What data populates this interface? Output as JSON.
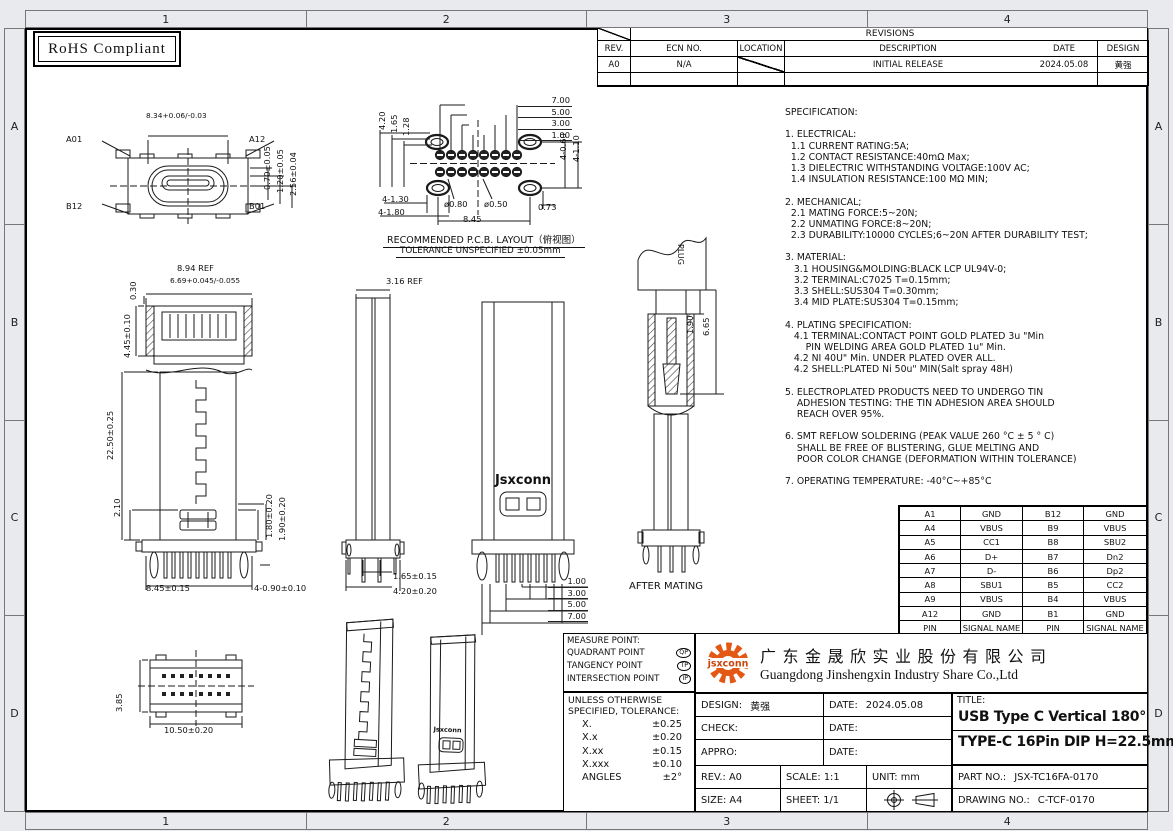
{
  "sheet": {
    "rohs": "RoHS Compliant",
    "zone_cols": [
      "1",
      "2",
      "3",
      "4"
    ],
    "zone_rows": [
      "A",
      "B",
      "C",
      "D"
    ]
  },
  "revisions": {
    "title": "REVISIONS",
    "headers": [
      "REV.",
      "ECN NO.",
      "LOCATION",
      "DESCRIPTION",
      "DATE",
      "DESIGN"
    ],
    "row": {
      "rev": "A0",
      "ecn": "N/A",
      "desc": "INITIAL RELEASE",
      "date": "2024.05.08",
      "design": "黄强"
    }
  },
  "specification": {
    "lines": [
      "SPECIFICATION:",
      "",
      "1. ELECTRICAL:",
      "  1.1 CURRENT RATING:5A;",
      "  1.2 CONTACT RESISTANCE:40mΩ Max;",
      "  1.3 DIELECTRIC WITHSTANDING VOLTAGE:100V AC;",
      "  1.4 INSULATION RESISTANCE:100 MΩ MIN;",
      "",
      "2. MECHANICAL;",
      "  2.1 MATING FORCE:5~20N;",
      "  2.2 UNMATING FORCE:8~20N;",
      "  2.3 DURABILITY:10000 CYCLES;6~20N AFTER DURABILITY TEST;",
      "",
      "3. MATERIAL:",
      "   3.1 HOUSING&MOLDING:BLACK LCP UL94V-0;",
      "   3.2 TERMINAL:C7025 T=0.15mm;",
      "   3.3 SHELL:SUS304 T=0.30mm;",
      "   3.4 MID PLATE:SUS304 T=0.15mm;",
      "",
      "4. PLATING SPECIFICATION:",
      "   4.1 TERMINAL:CONTACT POINT GOLD PLATED 3u \"Min",
      "       PIN WELDING AREA GOLD PLATED 1u\" Min.",
      "   4.2 NI 40U\" Min. UNDER PLATED OVER ALL.",
      "   4.2 SHELL:PLATED Ni 50u\" MIN(Salt spray 48H)",
      "",
      "5. ELECTROPLATED PRODUCTS NEED TO UNDERGO TIN",
      "    ADHESION TESTING: THE TIN ADHESION AREA SHOULD",
      "    REACH OVER 95%.",
      "",
      "6. SMT REFLOW SOLDERING (PEAK VALUE 260 °C ± 5 ° C)",
      "    SHALL BE FREE OF BLISTERING, GLUE MELTING AND",
      "    POOR COLOR CHANGE (DEFORMATION WITHIN TOLERANCE)",
      "",
      "7. OPERATING TEMPERATURE: -40°C~+85°C"
    ]
  },
  "pin_table": {
    "rows": [
      [
        "A1",
        "GND",
        "B12",
        "GND"
      ],
      [
        "A4",
        "VBUS",
        "B9",
        "VBUS"
      ],
      [
        "A5",
        "CC1",
        "B8",
        "SBU2"
      ],
      [
        "A6",
        "D+",
        "B7",
        "Dn2"
      ],
      [
        "A7",
        "D-",
        "B6",
        "Dp2"
      ],
      [
        "A8",
        "SBU1",
        "B5",
        "CC2"
      ],
      [
        "A9",
        "VBUS",
        "B4",
        "VBUS"
      ],
      [
        "A12",
        "GND",
        "B1",
        "GND"
      ],
      [
        "PIN",
        "SIGNAL NAME",
        "PIN",
        "SIGNAL NAME"
      ]
    ]
  },
  "views": {
    "top": {
      "pins": [
        "A01",
        "A12",
        "B12",
        "B01"
      ],
      "w": "8.34+0.06/-0.03",
      "right": [
        "0.70±0.05",
        "1.20±0.05",
        "2.56±0.04"
      ]
    },
    "pcb": {
      "left": [
        "4.20",
        "1.65",
        "1.28"
      ],
      "top": [
        "7.00",
        "5.00",
        "3.00",
        "1.00"
      ],
      "right": [
        "4-0.60",
        "4-1.10"
      ],
      "holes": [
        "4-1.30",
        "4-1.80"
      ],
      "dia": [
        "ø0.80",
        "ø0.50"
      ],
      "span": "8.45",
      "off": "0.73",
      "caption": "RECOMMENDED   P.C.B.  LAYOUT（俯视图）",
      "note": "TOLERANCE  UNSPECIFIED  ±0.05mm"
    },
    "front": {
      "w_ref": "8.94  REF",
      "tongue": "6.69+0.045/-0.055",
      "d030": "0.30",
      "d445": "4.45±0.10",
      "d2250": "22.50±0.25",
      "d210": "2.10",
      "d180": "1.80±0.20",
      "d190": "1.90±0.20",
      "span": "8.45±0.15",
      "holes": "4-0.90±0.10"
    },
    "side": {
      "w_ref": "3.16  REF",
      "d165": "1.65±0.15",
      "d420": "4.20±0.20"
    },
    "back": {
      "brand": "Jsxconn",
      "dims": [
        "1.00",
        "3.00",
        "5.00",
        "7.00"
      ]
    },
    "mating": {
      "plug": "PLUG",
      "d190": "1.90",
      "d665": "6.65",
      "caption": "AFTER  MATING"
    },
    "bottom": {
      "h": "3.85",
      "w": "10.50±0.20"
    }
  },
  "title_block": {
    "measure": {
      "title": "MEASURE POINT:",
      "rows": [
        {
          "label": "QUADRANT POINT",
          "sym": "QP"
        },
        {
          "label": "TANGENCY POINT",
          "sym": "TP"
        },
        {
          "label": "INTERSECTION POINT",
          "sym": "IP"
        }
      ]
    },
    "tol": {
      "l1": "UNLESS OTHERWISE",
      "l2": "SPECIFIED, TOLERANCE:",
      "rows": [
        {
          "k": "X.",
          "v": "±0.25"
        },
        {
          "k": "X.x",
          "v": "±0.20"
        },
        {
          "k": "X.xx",
          "v": "±0.15"
        },
        {
          "k": "X.xxx",
          "v": "±0.10"
        },
        {
          "k": "ANGLES",
          "v": "±2°"
        }
      ]
    },
    "company": {
      "logo": "jsxconn",
      "cn": "广东金晟欣实业股份有限公司",
      "en": "Guangdong Jinshengxin Industry Share Co.,Ltd"
    },
    "design_l": "DESIGN:",
    "design_v": "黄强",
    "check_l": "CHECK:",
    "appro_l": "APPRO:",
    "date_l": "DATE:",
    "design_date": "2024.05.08",
    "rev": "REV.: A0",
    "scale": "SCALE: 1:1",
    "unit": "UNIT: mm",
    "size": "SIZE: A4",
    "sheet": "SHEET: 1/1",
    "title_l": "TITLE:",
    "title1": "USB Type C Vertical 180°",
    "title2": "TYPE-C 16Pin DIP H=22.5mm",
    "part_l": "PART NO.:",
    "part": "JSX-TC16FA-0170",
    "drawing_l": "DRAWING NO.:",
    "drawing": "C-TCF-0170"
  }
}
